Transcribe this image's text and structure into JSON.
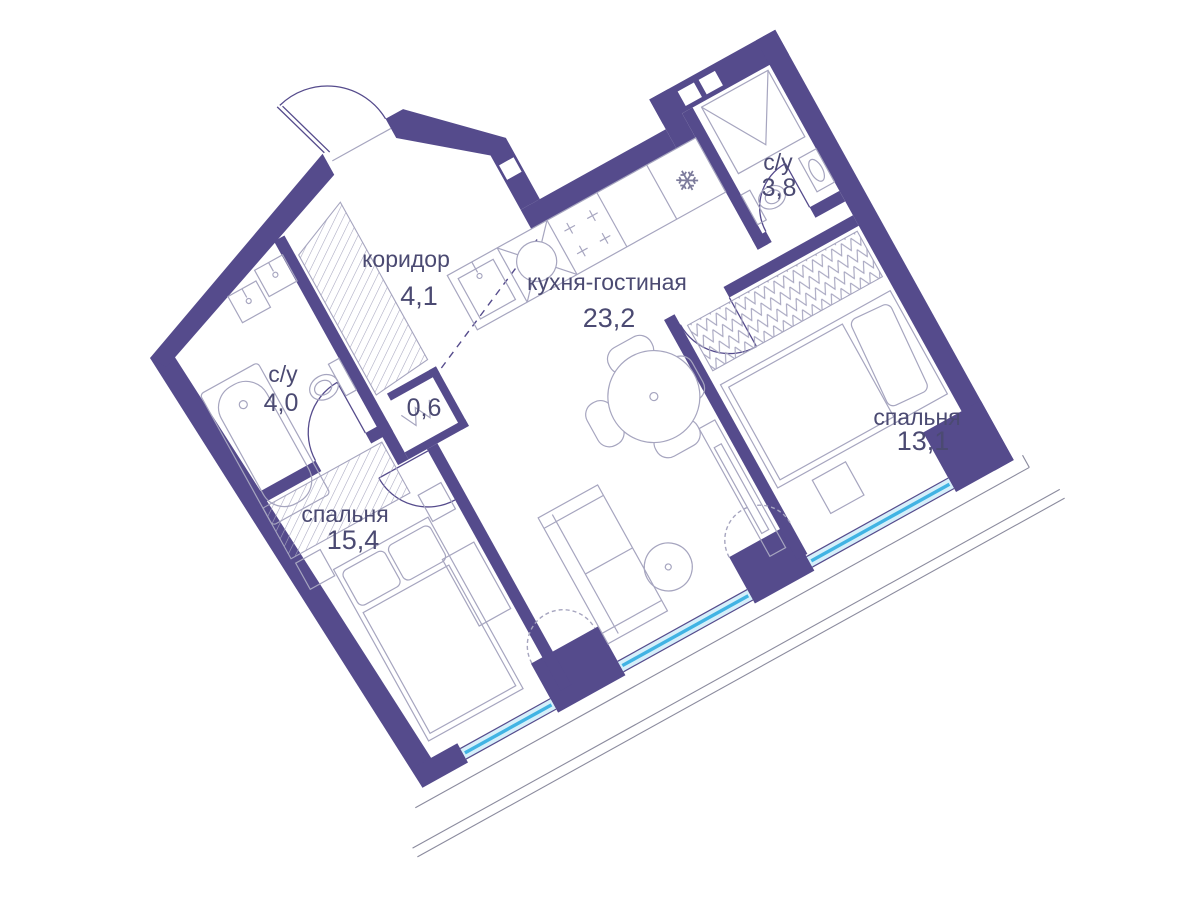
{
  "plan": {
    "type": "apartment-floor-plan",
    "language": "ru",
    "rotation_deg": -29,
    "rooms": [
      {
        "id": "hallway",
        "name": "коридор",
        "area": "4,1"
      },
      {
        "id": "kitchen-living",
        "name": "кухня-гостиная",
        "area": "23,2"
      },
      {
        "id": "bathroom-guest",
        "name": "с/у",
        "area": "3,8"
      },
      {
        "id": "bedroom-2",
        "name": "спальня",
        "area": "13,1"
      },
      {
        "id": "bathroom-main",
        "name": "с/у",
        "area": "4,0"
      },
      {
        "id": "niche",
        "name": "",
        "area": "0,6"
      },
      {
        "id": "bedroom-1",
        "name": "спальня",
        "area": "15,4"
      }
    ],
    "colors": {
      "wall": "#554b8c",
      "line": "#a6a5bf",
      "text": "#4b4a72",
      "window_glass": "#d6effa",
      "window_frame": "#41b3e3",
      "balcony_line": "#8b8b9e",
      "background": "#ffffff"
    },
    "icons": {
      "fridge_glyph": "❄",
      "fridge": "snowflake-icon",
      "washing_machine": "zigzag-icon"
    }
  }
}
